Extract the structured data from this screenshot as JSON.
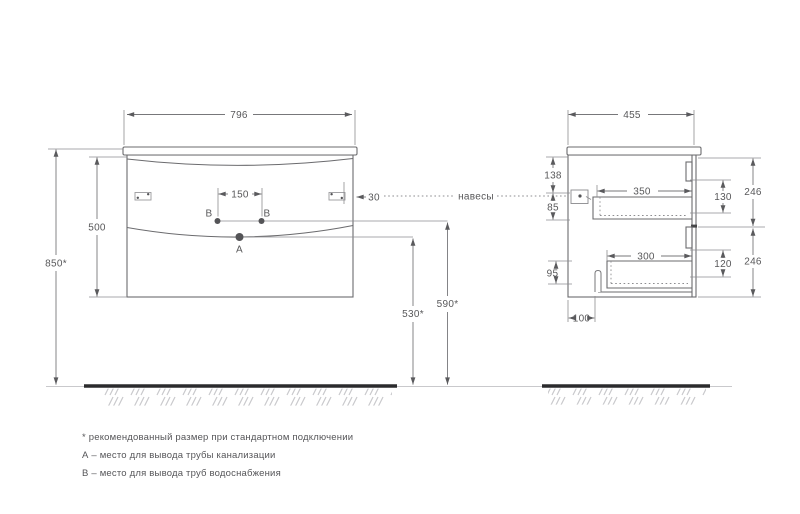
{
  "drawing": {
    "front": {
      "width": "796",
      "cabinet_height": "500",
      "mount_height": "850*",
      "supply_spacing": "150",
      "hanger_inset": "30",
      "drain_outlet_height": "530*",
      "supply_outlet_height": "590*"
    },
    "side": {
      "depth": "455",
      "hanger_from_top": "138",
      "hanger_to_drawer": "85",
      "drawer_side_height": "95",
      "top_drawer_depth": "350",
      "bottom_drawer_depth": "300",
      "pipe_from_back": "100",
      "top_drawer_inner_height": "130",
      "bottom_drawer_inner_height": "120",
      "top_front_height": "246",
      "bottom_front_height": "246"
    },
    "labels": {
      "hangers": "навесы",
      "point_a": "А",
      "point_b_left": "В",
      "point_b_right": "В"
    },
    "notes": [
      "* рекомендованный размер при стандартном подключении",
      "А – место для вывода трубы канализации",
      "В – место для вывода труб водоснабжения"
    ],
    "colors": {
      "line": "#6b6b6e",
      "dimension_text": "#58585a",
      "floor": "#2b2b2d",
      "hatch": "#c9c9cc",
      "background": "#ffffff"
    }
  }
}
